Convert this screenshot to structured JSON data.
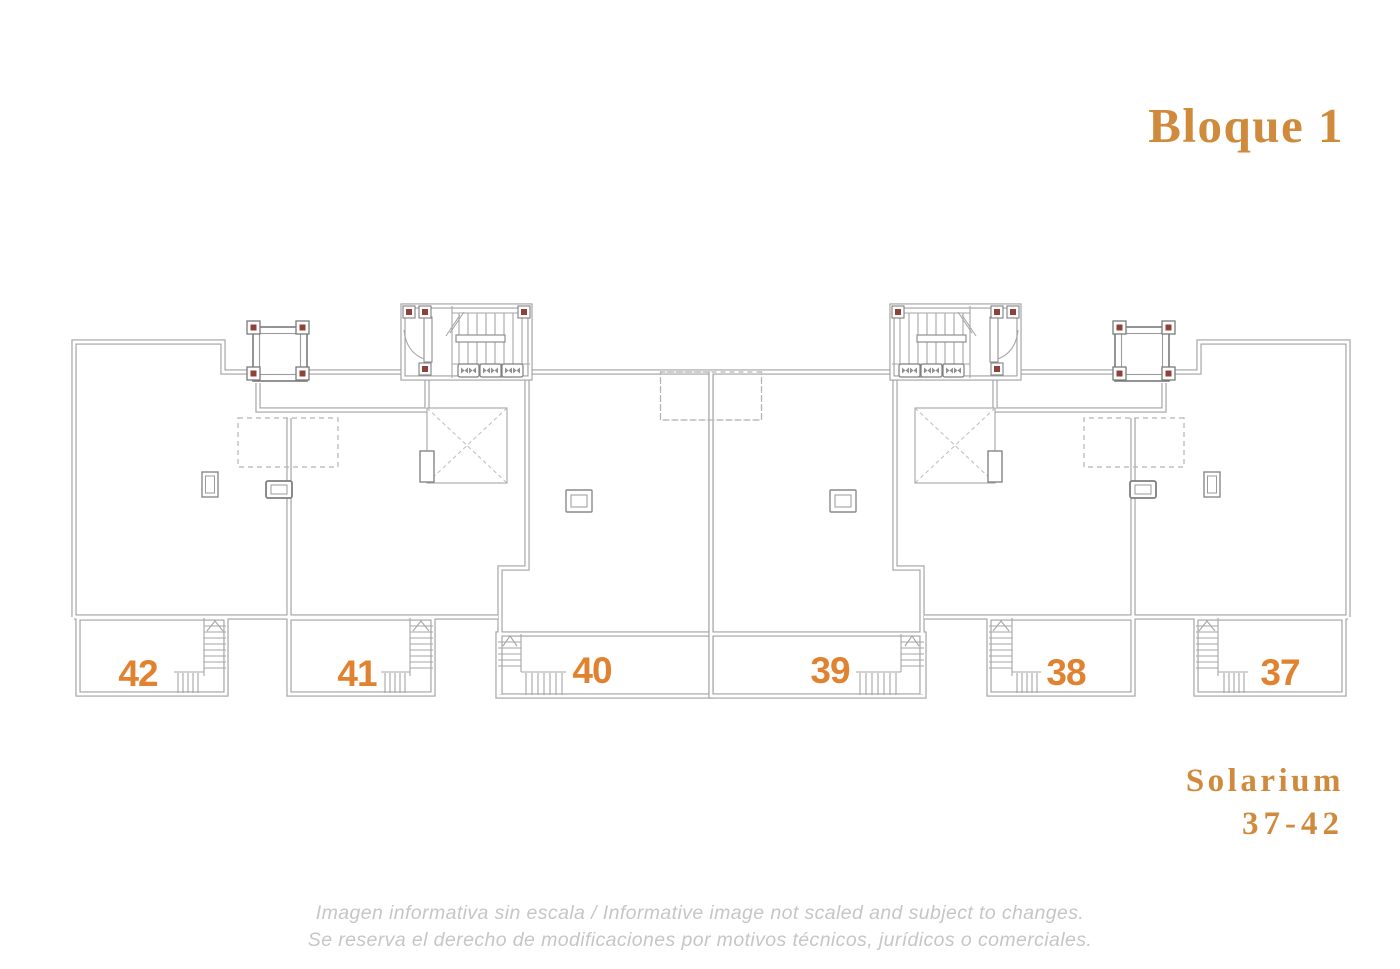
{
  "header": {
    "title": "Bloque 1"
  },
  "plan": {
    "units": [
      {
        "number": "42"
      },
      {
        "number": "41"
      },
      {
        "number": "40"
      },
      {
        "number": "39"
      },
      {
        "number": "38"
      },
      {
        "number": "37"
      }
    ],
    "caption_line1": "Solarium",
    "caption_line2": "37-42"
  },
  "footer": {
    "line1": "Imagen informativa sin escala / Informative image not scaled and subject to changes.",
    "line2": "Se reserva el derecho de modificaciones por motivos técnicos, jurídicos o comerciales."
  },
  "colors": {
    "accent_orange": "#d08a3c",
    "unit_orange": "#e08230",
    "marker_red": "#90423a",
    "line_gray": "#a2a2a2",
    "dashed_gray": "#b4b4b4",
    "disclaimer_gray": "#c6c6c6"
  }
}
